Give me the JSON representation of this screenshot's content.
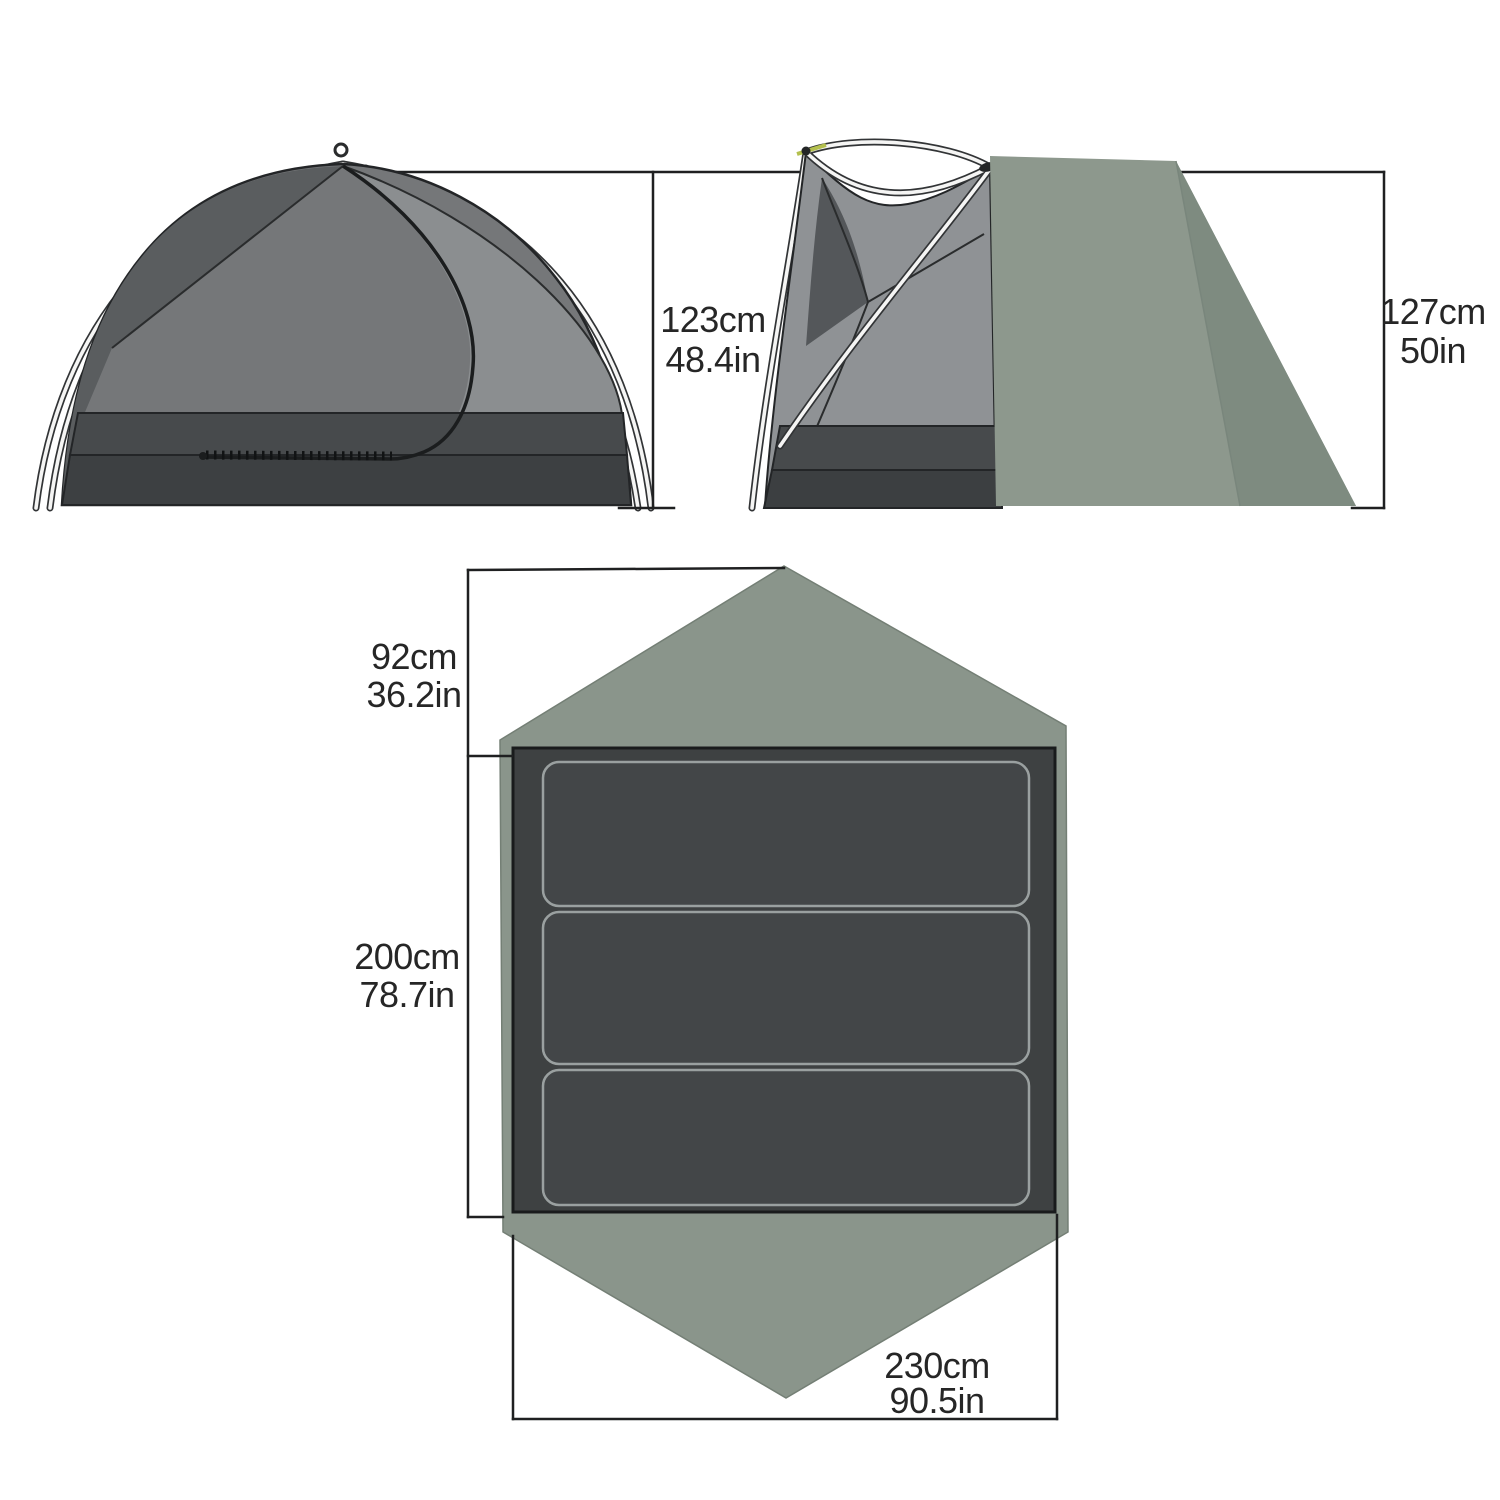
{
  "diagram_title": "Tent dimensions diagram",
  "side_view": {
    "height_cm": "123cm",
    "height_in": "48.4in"
  },
  "end_view": {
    "height_cm": "127cm",
    "height_in": "50in"
  },
  "floor_plan": {
    "vestibule_depth_cm": "92cm",
    "vestibule_depth_in": "36.2in",
    "floor_length_cm": "200cm",
    "floor_length_in": "78.7in",
    "floor_width_cm": "230cm",
    "floor_width_in": "90.5in",
    "sleeping_pad_count": 3
  },
  "colors": {
    "background": "#ffffff",
    "dimension_line": "#1f2021",
    "label_text": "#262626",
    "fly_green": "#8d988d",
    "fly_green_dark": "#7e8b80",
    "footprint_green": "#8a958b",
    "floor_dark": "#3e4142",
    "pad_fill": "#434648",
    "pad_outline": "#9aa0a0",
    "tent_mesh_gray": "#757779",
    "tent_mesh_light": "#8b8e90",
    "tent_mesh_dark": "#595c5e",
    "bathtub_upper": "#474a4c",
    "bathtub_lower": "#3d4042",
    "pole_white": "#f5f5f4",
    "accent_yellow_green": "#b4c04e"
  }
}
